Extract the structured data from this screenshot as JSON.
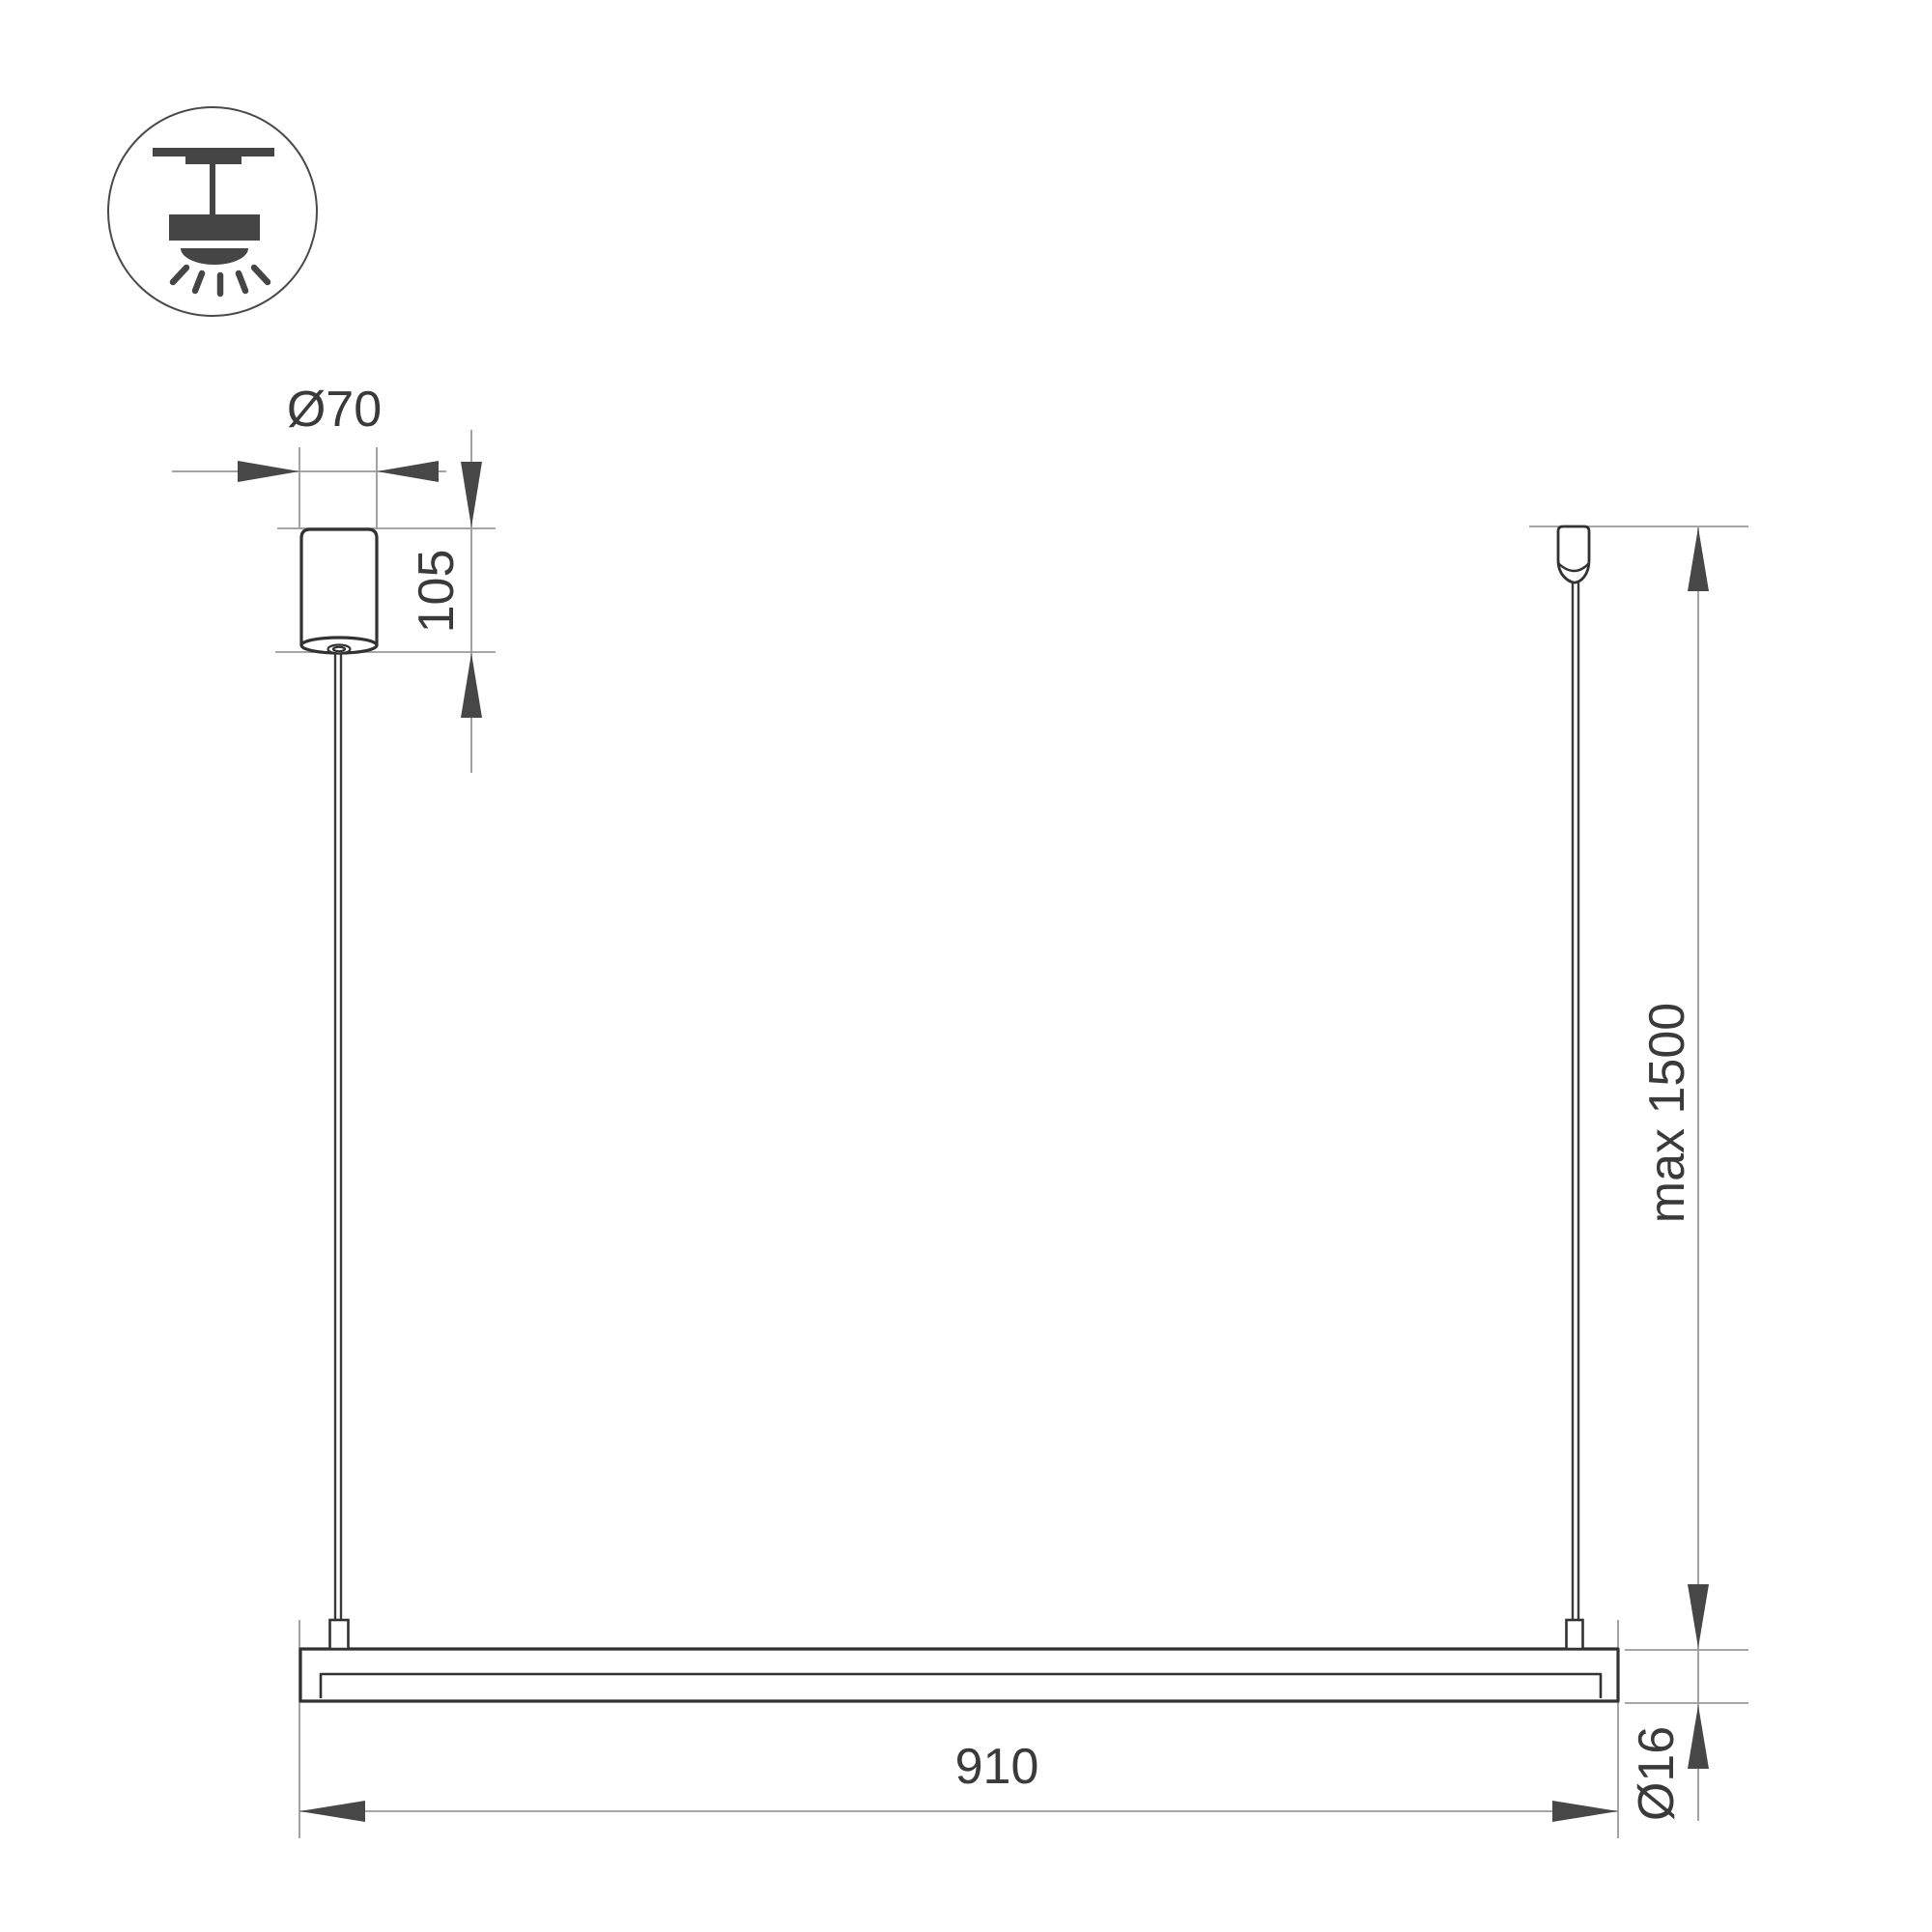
{
  "drawing": {
    "title": "Linear pendant luminaire installation dimensions",
    "type": "technical-dimension-drawing",
    "labels": {
      "canopy_diameter": "Ø70",
      "canopy_height": "105",
      "suspension_length": "max 1500",
      "fixture_length": "910",
      "tube_diameter": "Ø16"
    },
    "icon": "ceiling-pendant-light",
    "colors": {
      "background": "#ffffff",
      "object_outline": "#323232",
      "dimension_line": "#9a9a9a",
      "arrow_and_text": "#3d3d3d"
    }
  }
}
